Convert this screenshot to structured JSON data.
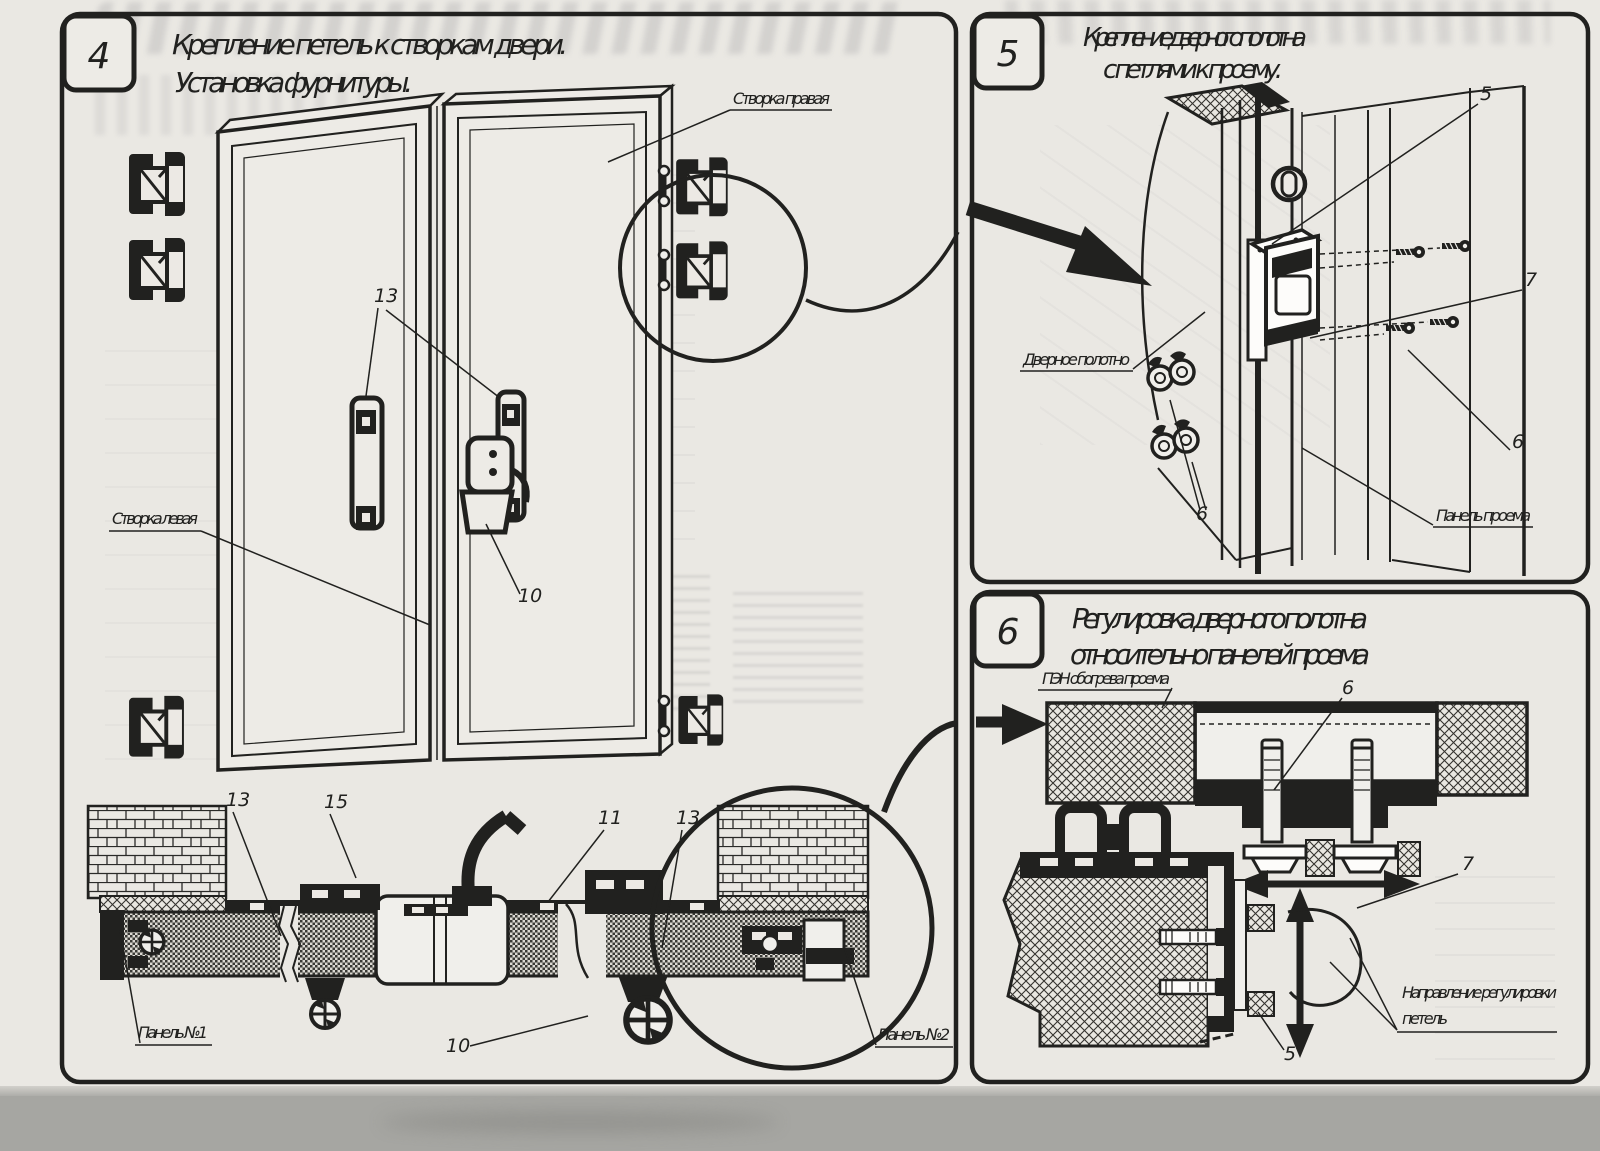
{
  "panel4": {
    "number": "4",
    "title_line1": "Крепление петель к створкам двери.",
    "title_line2": "Установка фурнитуры.",
    "label_right_leaf": "Створка правая",
    "label_left_leaf": "Створка левая",
    "label_panel_1": "Панель №1",
    "label_panel_2": "Панель №2",
    "callout_hinge_handles": "13",
    "callout_latch": "10",
    "callout_section_13_left": "13",
    "callout_section_15": "15",
    "callout_section_11": "11",
    "callout_section_13_right": "13",
    "callout_section_10": "10"
  },
  "panel5": {
    "number": "5",
    "title_line1": "Крепление дверного полотна",
    "title_line2": "с петлями к проему.",
    "label_door_leaf": "Дверное полотно",
    "label_opening_panel": "Панель проема",
    "callout_hinge": "5",
    "callout_screws": "7",
    "callout_screw_right": "6",
    "callout_bolts_bottom": "6"
  },
  "panel6": {
    "number": "6",
    "title_line1": "Регулировка дверного полотна",
    "title_line2": "относительно панелей проема",
    "label_heater": "ПЭН обогрева проема",
    "label_direction_line1": "Направление регулировки",
    "label_direction_line2": "петель",
    "callout_bolt": "6",
    "callout_hinge_adjust": "7",
    "callout_bottom": "5"
  },
  "colors": {
    "ink": "#21211f",
    "paper": "#eae8e3",
    "panel_fill": "#edebe6",
    "scanner_background": "#a6a6a2"
  }
}
